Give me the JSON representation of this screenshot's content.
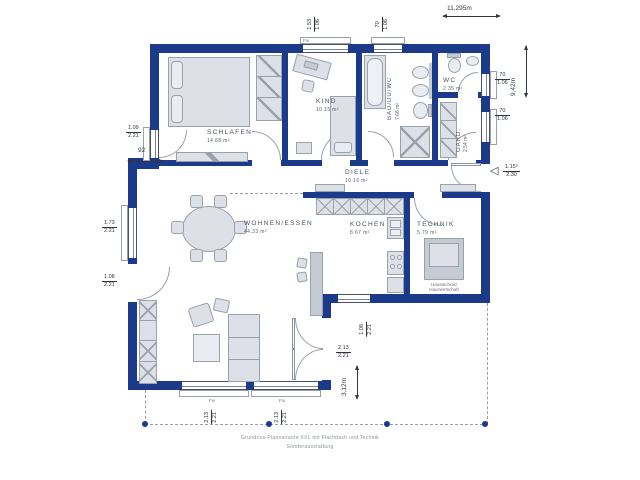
{
  "rooms": {
    "schlafen": {
      "label": "SCHLAFEN",
      "area": "14.68 m²"
    },
    "kind": {
      "label": "KIND",
      "area": "10.15 m²"
    },
    "bad": {
      "label": "BAD/DU/WC",
      "area": "7.66 m²"
    },
    "wc": {
      "label": "WC",
      "area": "2.35 m²"
    },
    "gard": {
      "label": "GARD.",
      "area": "2.54 m²"
    },
    "diele": {
      "label": "DIELE",
      "area": "10.16 m²"
    },
    "wohnen": {
      "label": "WOHNEN/ESSEN",
      "area": "44.33 m²"
    },
    "kochen": {
      "label": "KOCHEN",
      "area": "8.67 m²"
    },
    "technik": {
      "label": "TECHNIK",
      "area": "5.79 m²",
      "note1": "Haustechnik/",
      "note2": "Hauswirtschaft"
    }
  },
  "dimensions": {
    "total_width": "11,295m",
    "total_height": "9,42m",
    "terrace_depth": "3,12m",
    "wall_jog": "92"
  },
  "openings": {
    "north_window_kind": {
      "w": "1.53",
      "h": "1.06"
    },
    "north_window_bad": {
      "w": "70",
      "h": "1.06"
    },
    "east_window_wc": {
      "w": "70",
      "h": "1.06"
    },
    "east_window_gard": {
      "w": "70",
      "h": "1.06"
    },
    "entrance_door": {
      "w": "1.15⁵",
      "h": "2.30"
    },
    "west_window_schlafen": {
      "w": "1.09",
      "h": "2.21"
    },
    "west_window_wohnen": {
      "w": "1.73",
      "h": "2.21"
    },
    "west_door_wohnen": {
      "w": "1.08",
      "h": "2.21"
    },
    "south_window_left": {
      "w": "2.13",
      "h": "2.21"
    },
    "south_window_right": {
      "w": "2.13",
      "h": "2.21"
    },
    "terrace_door": {
      "w": "2.13",
      "h": "2.21"
    },
    "terrace_side_door": {
      "w": "1.08",
      "h": "2.21"
    },
    "fix_label": "Fix"
  },
  "footer": {
    "line1": "Grundriss-Planvariante XXL mit Flachdach und Technik",
    "line2": "Sonderausstattung"
  },
  "colors": {
    "wall": "#1b3a8a",
    "furniture_fill": "#dde1e7",
    "furniture_outline": "#99a1ac",
    "label_text": "#4a5260"
  }
}
